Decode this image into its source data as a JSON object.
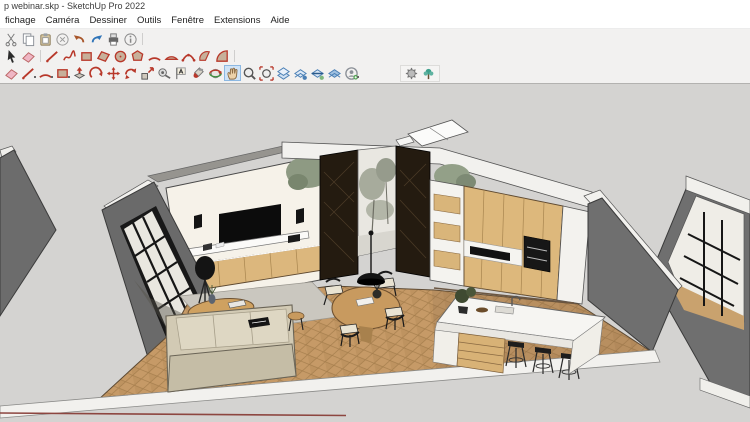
{
  "window": {
    "title": "p webinar.skp - SketchUp Pro 2022"
  },
  "menu": {
    "items": [
      "fichage",
      "Caméra",
      "Dessiner",
      "Outils",
      "Fenêtre",
      "Extensions",
      "Aide"
    ]
  },
  "toolbars": {
    "active_tool": "pan",
    "row1": [
      {
        "icon": "cut"
      },
      {
        "icon": "copy"
      },
      {
        "icon": "paste"
      },
      {
        "icon": "delete"
      },
      {
        "icon": "undo"
      },
      {
        "icon": "redo"
      },
      {
        "icon": "print"
      },
      {
        "icon": "model-info"
      },
      {
        "sep": true
      }
    ],
    "row2": [
      {
        "icon": "select"
      },
      {
        "icon": "eraser"
      },
      {
        "sep": true
      },
      {
        "icon": "line"
      },
      {
        "icon": "freehand"
      },
      {
        "icon": "rectangle"
      },
      {
        "icon": "rotated-rectangle"
      },
      {
        "icon": "circle"
      },
      {
        "icon": "polygon"
      },
      {
        "icon": "arc"
      },
      {
        "icon": "2-point-arc"
      },
      {
        "icon": "3-point-arc"
      },
      {
        "icon": "pie"
      },
      {
        "icon": "pie-filled"
      },
      {
        "sep": true
      }
    ],
    "row3": [
      {
        "icon": "eraser"
      },
      {
        "icon": "line",
        "dropdown": true
      },
      {
        "icon": "arc",
        "dropdown": true
      },
      {
        "icon": "rectangle",
        "dropdown": true
      },
      {
        "icon": "push-pull"
      },
      {
        "icon": "follow-me"
      },
      {
        "icon": "move"
      },
      {
        "icon": "rotate"
      },
      {
        "icon": "scale"
      },
      {
        "icon": "tape-measure"
      },
      {
        "icon": "text"
      },
      {
        "icon": "paint-bucket"
      },
      {
        "icon": "orbit"
      },
      {
        "icon": "pan",
        "active": true
      },
      {
        "icon": "zoom"
      },
      {
        "icon": "zoom-extents"
      },
      {
        "icon": "section-plane"
      },
      {
        "icon": "display-section-planes"
      },
      {
        "icon": "display-section-cuts"
      },
      {
        "icon": "section-fill"
      },
      {
        "icon": "account",
        "dropdown": true
      }
    ],
    "extensions_island": [
      {
        "icon": "extension-a"
      },
      {
        "icon": "extension-b"
      }
    ]
  },
  "palette": {
    "accent_red": "#b8382a",
    "accent_blue": "#4a7fb5",
    "active_tool_bg": "#cfe3f6",
    "chrome_bg": "#f2f1f0",
    "viewport_bg": "#d4d3d1",
    "wall_gray": "#6e6e6e",
    "wall_white": "#f4f2ec",
    "wood_light": "#ddb87c",
    "floor_wood": "#c69a67",
    "dark_panel": "#241b10"
  }
}
